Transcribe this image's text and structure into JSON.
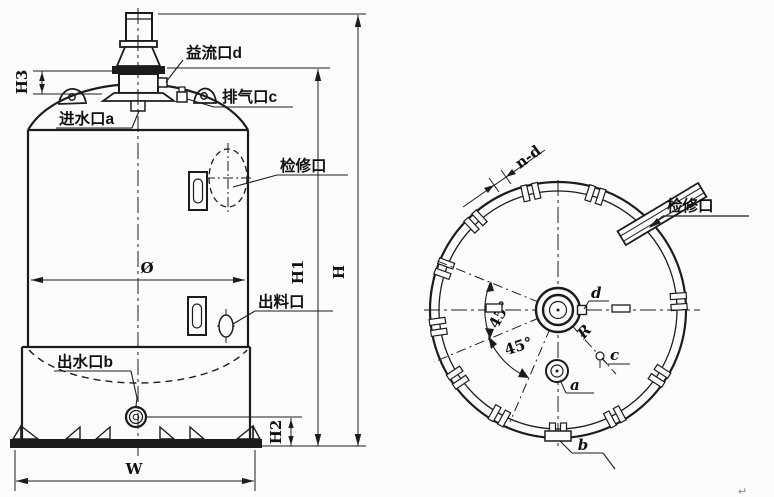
{
  "front_view": {
    "port_labels": {
      "overflow_d": "益流口d",
      "vent_c": "排气口c",
      "inlet_a": "进水口a",
      "manhole": "检修口",
      "discharge": "出料口",
      "outlet_b": "出水口b"
    },
    "dimensions": {
      "h3": "H3",
      "h1": "H1",
      "h": "H",
      "h2": "H2",
      "w": "W",
      "diameter": "Ø"
    }
  },
  "plan_view": {
    "labels": {
      "bolt_spec": "n-d",
      "manhole": "检修口",
      "radius": "R",
      "port_d": "d",
      "port_c": "c",
      "port_a": "a",
      "port_b": "b"
    },
    "angles": {
      "upper": "45°",
      "lower": "45°"
    }
  },
  "page": {
    "paragraph_mark": "↵"
  },
  "colors": {
    "line": "#1c1c1c",
    "background": "#fcfcfa"
  }
}
